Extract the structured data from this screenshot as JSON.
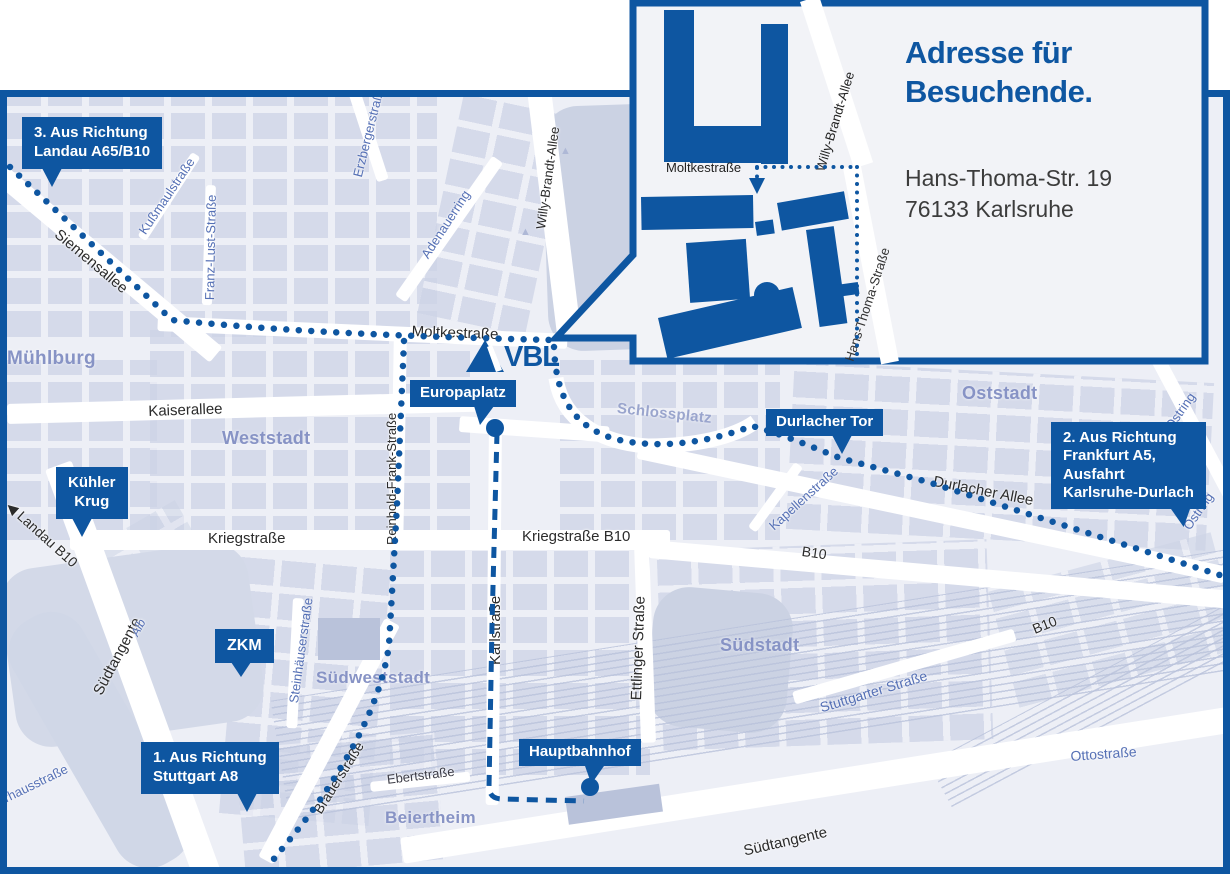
{
  "colors": {
    "brand_blue": "#0E56A1",
    "map_background": "#edeff6",
    "building_block": "#cdd4e6",
    "district_text": "#8793c5",
    "street_blue_text": "#5570b5",
    "street_black_text": "#2b2b2b"
  },
  "logo": {
    "vbl": "VBL"
  },
  "inset": {
    "title": [
      "Adresse für",
      "Besuchende."
    ],
    "address": [
      "Hans-Thoma-Str. 19",
      "76133 Karlsruhe"
    ],
    "streets": {
      "moltkestrasse": "Moltkestraße",
      "willy_brandt_allee": "Willy-Brandt-Allee",
      "hans_thoma_strasse": "Hans-Thoma-Straße"
    }
  },
  "callouts": {
    "route3": {
      "lines": [
        "3. Aus Richtung",
        "Landau A65/B10"
      ]
    },
    "route2": {
      "lines": [
        "2. Aus Richtung",
        "Frankfurt A5,",
        "Ausfahrt",
        "Karlsruhe-Durlach"
      ]
    },
    "route1": {
      "lines": [
        "1. Aus Richtung",
        "Stuttgart A8"
      ]
    },
    "kuehler_krug": {
      "lines": [
        "Kühler",
        "Krug"
      ]
    },
    "zkm": {
      "lines": [
        "ZKM"
      ]
    },
    "europaplatz": {
      "lines": [
        "Europaplatz"
      ]
    },
    "durlacher_tor": {
      "lines": [
        "Durlacher Tor"
      ]
    },
    "hauptbahnhof": {
      "lines": [
        "Hauptbahnhof"
      ]
    }
  },
  "districts": {
    "muehlburg": "Mühlburg",
    "weststadt": "Weststadt",
    "oststadt": "Oststadt",
    "suedstadt": "Südstadt",
    "suedweststadt": "Südweststadt",
    "beiertheim": "Beiertheim",
    "schlossplatz": "Schlossplatz"
  },
  "streets": {
    "siemensallee": "Siemensallee",
    "kussmaulstrasse": "Kußmaulstraße",
    "franz_lust_strasse": "Franz-Lust-Straße",
    "erzbergerstrasse": "Erzbergerstraße",
    "adenauerring": "Adenauerring",
    "willy_brandt_allee": "Willy-Brandt-Allee",
    "moltkestrasse": "Moltkestraße",
    "kaiserallee": "Kaiserallee",
    "reinhold_frank_strasse": "Reinhold-Frank-Straße",
    "karlstrasse": "Karlstraße",
    "kriegstrasse": "Kriegstraße",
    "kriegstrasse_b10": "Kriegstraße B10",
    "ettlinger_strasse": "Ettlinger Straße",
    "kapellenstrasse": "Kapellenstraße",
    "durlacher_allee": "Durlacher Allee",
    "b10_east": "B10",
    "b10_southeast": "B10",
    "ostring": "Ostring",
    "stuttgarter_strasse": "Stuttgarter Straße",
    "ottostrasse": "Ottostraße",
    "steinhaeuserstrasse": "Steinhäuserstraße",
    "brauerstrasse": "Brauerstraße",
    "ebertstrasse": "Ebertstraße",
    "suedtangente": "Südtangente",
    "alb": "Alb",
    "pulverhausstrasse": "Pulverhausstraße",
    "landau_b10": "Landau B10",
    "landau_arrow": "◀"
  }
}
